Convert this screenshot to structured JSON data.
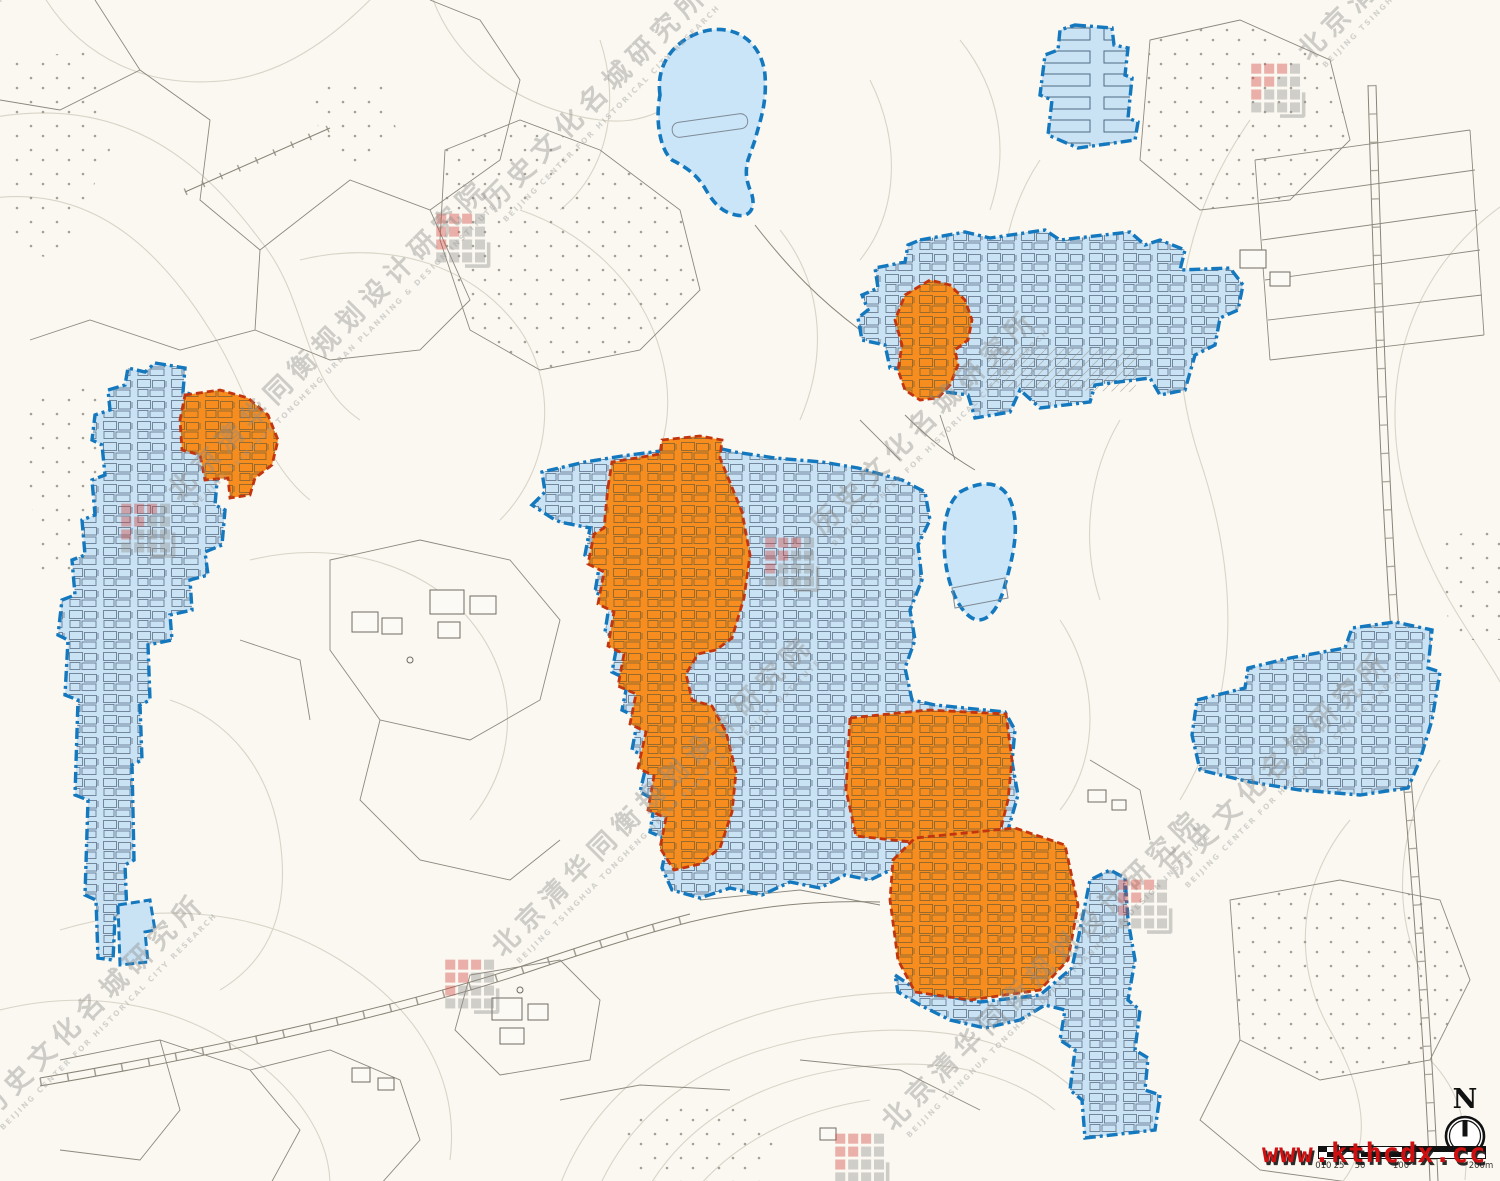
{
  "canvas": {
    "width": 1500,
    "height": 1181,
    "background": "#FAF8F1"
  },
  "palette": {
    "protection_zone_fill": "#C9E2F4",
    "protection_zone_border": "#1478BE",
    "core_area_fill": "#F78D1E",
    "core_area_border": "#C2350F",
    "water_fill": "#CBE5F8",
    "contour_line": "#D9D4C8",
    "parcel_line": "#8D897F",
    "watermark_gray": "#8E8C89",
    "watermark_red": "#D0453C",
    "url_red": "#D01010"
  },
  "watermarks": {
    "institute_a": {
      "cn": "历史文化名城研究所",
      "en": "BEIJING CENTER FOR HISTORICAL CITY RESEARCH"
    },
    "institute_b": {
      "cn": "北京清华同衡规划设计研究院",
      "en": "BEIJING TSINGHUA TONGHENG URBAN PLANNING & DESIGN INSTITUTE"
    }
  },
  "north_arrow": {
    "label": "N"
  },
  "scale_bar": {
    "unit_labels": [
      "0",
      "10",
      "25",
      "50",
      "100",
      "200m"
    ]
  },
  "overlay": {
    "url_watermark": "www.kthcdx.cc"
  }
}
